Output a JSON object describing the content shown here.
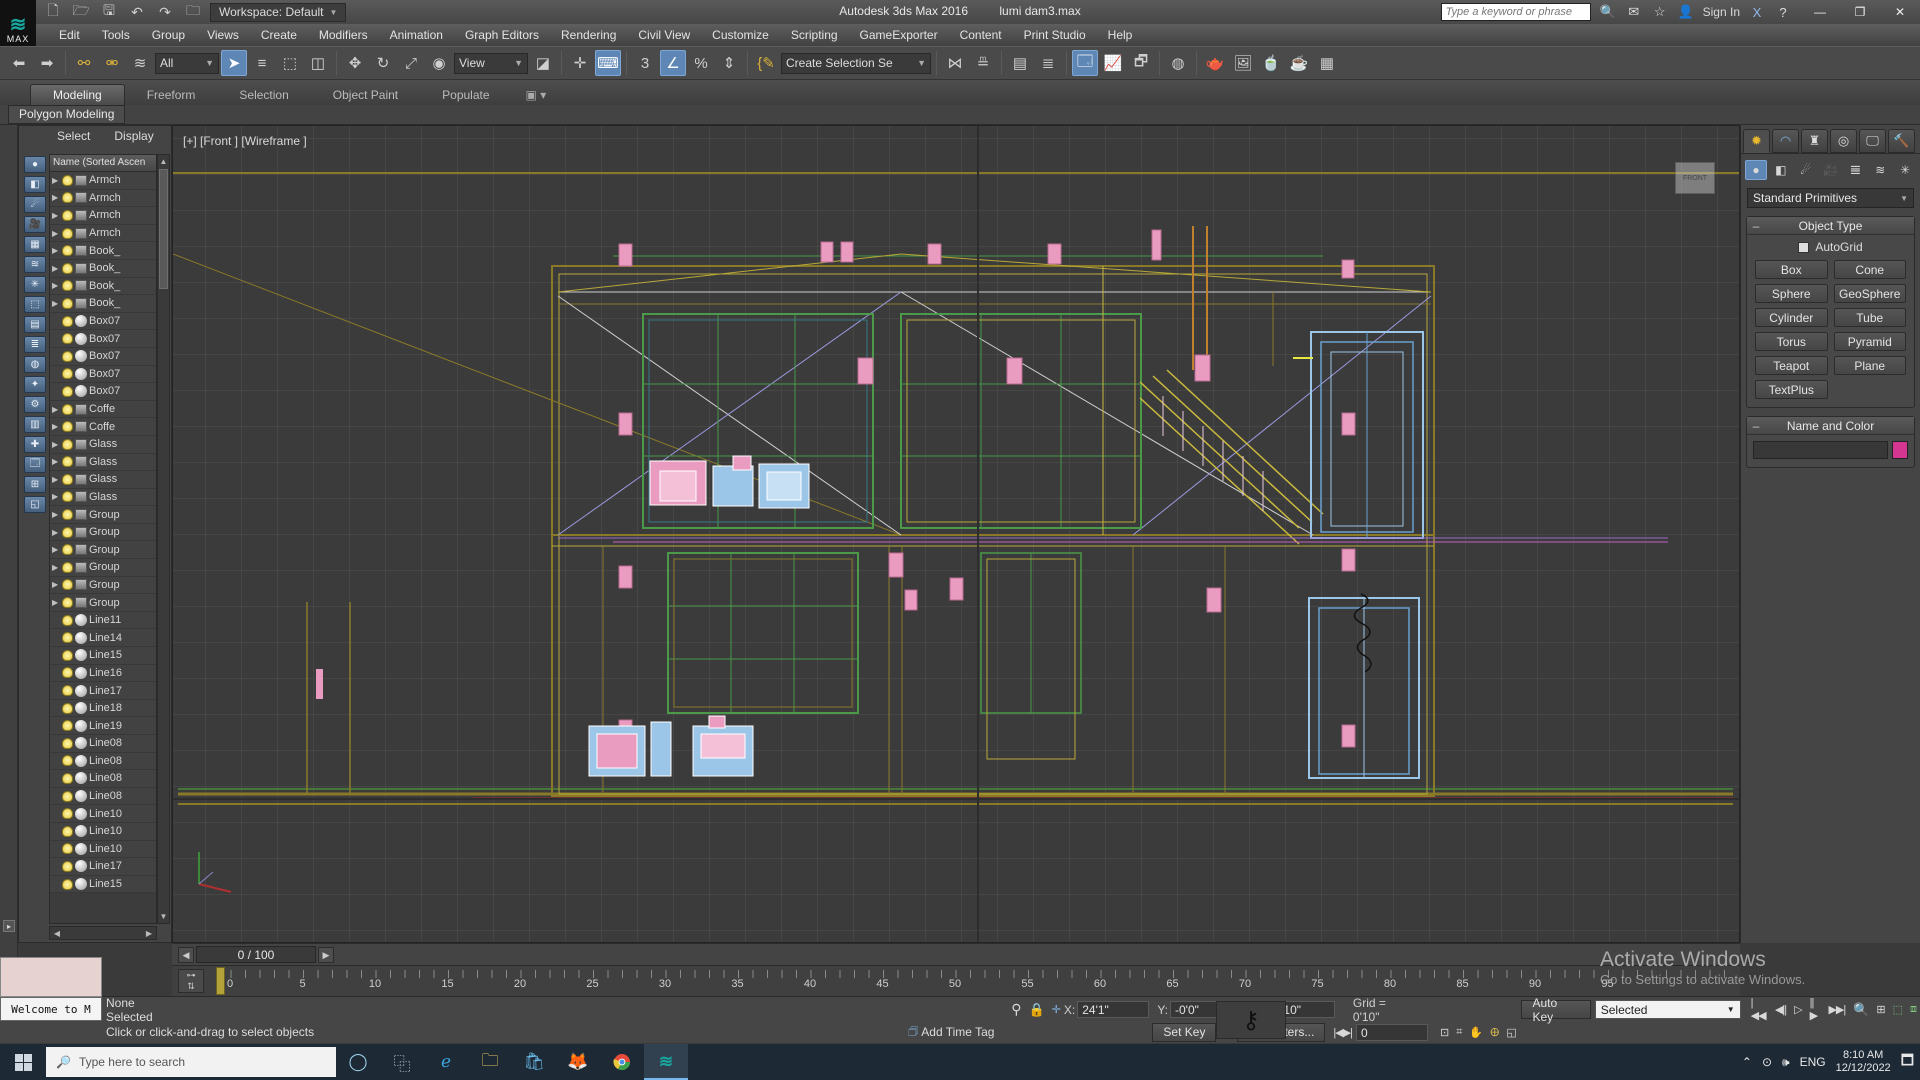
{
  "titlebar": {
    "logo_text": "MAX",
    "workspace": "Workspace: Default",
    "app_title": "Autodesk 3ds Max 2016",
    "file_name": "lumi dam3.max",
    "search_placeholder": "Type a keyword or phrase",
    "sign_in": "Sign In"
  },
  "menus": [
    "Edit",
    "Tools",
    "Group",
    "Views",
    "Create",
    "Modifiers",
    "Animation",
    "Graph Editors",
    "Rendering",
    "Civil View",
    "Customize",
    "Scripting",
    "GameExporter",
    "Content",
    "Print Studio",
    "Help"
  ],
  "toolbar": {
    "selection_filter_value": "All",
    "ref_coord_value": "View",
    "named_selection_value": "Create Selection Se",
    "snap_value": "3"
  },
  "ribbon": {
    "tabs": [
      "Modeling",
      "Freeform",
      "Selection",
      "Object Paint",
      "Populate"
    ],
    "active_tab": "Modeling",
    "panel_label": "Polygon Modeling"
  },
  "explorer": {
    "menu_items": [
      "Select",
      "Display"
    ],
    "header": "Name (Sorted Ascen",
    "rows": [
      {
        "label": "Armch",
        "kind": "group"
      },
      {
        "label": "Armch",
        "kind": "group"
      },
      {
        "label": "Armch",
        "kind": "group"
      },
      {
        "label": "Armch",
        "kind": "group"
      },
      {
        "label": "Book_",
        "kind": "group"
      },
      {
        "label": "Book_",
        "kind": "group"
      },
      {
        "label": "Book_",
        "kind": "group"
      },
      {
        "label": "Book_",
        "kind": "group"
      },
      {
        "label": "Box07",
        "kind": "mesh"
      },
      {
        "label": "Box07",
        "kind": "mesh"
      },
      {
        "label": "Box07",
        "kind": "mesh"
      },
      {
        "label": "Box07",
        "kind": "mesh"
      },
      {
        "label": "Box07",
        "kind": "mesh"
      },
      {
        "label": "Coffe",
        "kind": "group"
      },
      {
        "label": "Coffe",
        "kind": "group"
      },
      {
        "label": "Glass",
        "kind": "group"
      },
      {
        "label": "Glass",
        "kind": "group"
      },
      {
        "label": "Glass",
        "kind": "group"
      },
      {
        "label": "Glass",
        "kind": "group"
      },
      {
        "label": "Group",
        "kind": "group"
      },
      {
        "label": "Group",
        "kind": "group"
      },
      {
        "label": "Group",
        "kind": "group"
      },
      {
        "label": "Group",
        "kind": "group"
      },
      {
        "label": "Group",
        "kind": "group"
      },
      {
        "label": "Group",
        "kind": "group"
      },
      {
        "label": "Line11",
        "kind": "mesh"
      },
      {
        "label": "Line14",
        "kind": "mesh"
      },
      {
        "label": "Line15",
        "kind": "mesh"
      },
      {
        "label": "Line16",
        "kind": "mesh"
      },
      {
        "label": "Line17",
        "kind": "mesh"
      },
      {
        "label": "Line18",
        "kind": "mesh"
      },
      {
        "label": "Line19",
        "kind": "mesh"
      },
      {
        "label": "Line08",
        "kind": "mesh"
      },
      {
        "label": "Line08",
        "kind": "mesh"
      },
      {
        "label": "Line08",
        "kind": "mesh"
      },
      {
        "label": "Line08",
        "kind": "mesh"
      },
      {
        "label": "Line10",
        "kind": "mesh"
      },
      {
        "label": "Line10",
        "kind": "mesh"
      },
      {
        "label": "Line10",
        "kind": "mesh"
      },
      {
        "label": "Line17",
        "kind": "mesh"
      },
      {
        "label": "Line15",
        "kind": "mesh"
      }
    ]
  },
  "viewport": {
    "label": "[+] [Front ] [Wireframe ]",
    "viewcube_face": "FRONT"
  },
  "command_panel": {
    "category_value": "Standard Primitives",
    "object_type": {
      "title": "Object Type",
      "autogrid": "AutoGrid",
      "buttons": [
        "Box",
        "Cone",
        "Sphere",
        "GeoSphere",
        "Cylinder",
        "Tube",
        "Torus",
        "Pyramid",
        "Teapot",
        "Plane",
        "TextPlus"
      ]
    },
    "name_color": {
      "title": "Name and Color"
    }
  },
  "timeline": {
    "slider_value": "0 / 100",
    "labels": [
      "0",
      "5",
      "10",
      "15",
      "20",
      "25",
      "30",
      "35",
      "40",
      "45",
      "50",
      "55",
      "60",
      "65",
      "70",
      "75",
      "80",
      "85",
      "90",
      "95"
    ]
  },
  "status": {
    "listener_button": "Welcome to M",
    "selection_status": "None Selected",
    "prompt": "Click or click-and-drag to select objects",
    "x_label": "X:",
    "y_label": "Y:",
    "z_label": "Z:",
    "x_value": "24'1\"",
    "y_value": "-0'0\"",
    "z_value": "23'10\"",
    "grid_label": "Grid = 0'10\"",
    "add_time_tag": "Add Time Tag",
    "auto_key": "Auto Key",
    "set_key": "Set Key",
    "key_mode_value": "Selected",
    "key_filters": "Key Filters...",
    "frame_value": "0"
  },
  "watermark": {
    "line1": "Activate Windows",
    "line2": "Go to Settings to activate Windows."
  },
  "taskbar": {
    "search_placeholder": "Type here to search",
    "language": "ENG",
    "time": "8:10 AM",
    "date": "12/12/2022"
  },
  "colors": {
    "object_color_swatch": "#d5368f",
    "toolbar_highlight": "#5f87b5",
    "wire_olive": "#8a7a28",
    "wire_yellow": "#c9b93c",
    "wire_green": "#4a9a4a",
    "wire_pink": "#ea9cc0",
    "wire_blue": "#9cc6e8",
    "wire_purple": "#9a6ac8",
    "viewport_bg": "#3b3b3b",
    "taskbar_bg": "#1d2935"
  }
}
